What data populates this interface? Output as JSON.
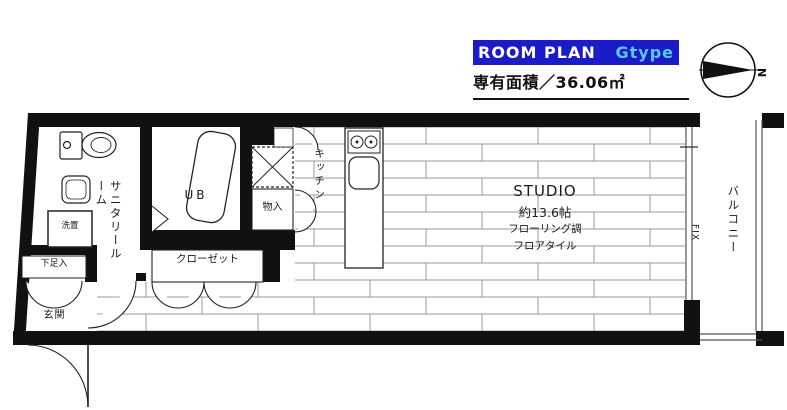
{
  "header": {
    "title_main": "ROOM PLAN",
    "title_type": "Gtype",
    "area_label": "専有面積／36.06㎡",
    "compass_north": "N"
  },
  "colors": {
    "title_bg": "#1b1bc8",
    "title_main_color": "#ffffff",
    "title_type_color": "#58c9f3",
    "wall": "#111111",
    "floor_line": "#9a9a9a"
  },
  "labels": {
    "sanitary_room": "サニタリールーム",
    "unit_bath": "UB",
    "closet": "クローゼット",
    "storage": "物入",
    "kitchen": "キッチン",
    "laundry": "洗置",
    "shoe_cabinet": "下足入",
    "entrance": "玄関",
    "balcony": "バルコニー",
    "fixed_window": "FIX",
    "studio": {
      "name": "STUDIO",
      "size": "約13.6帖",
      "floor_spec_1": "フローリング調",
      "floor_spec_2": "フロアタイル"
    }
  }
}
